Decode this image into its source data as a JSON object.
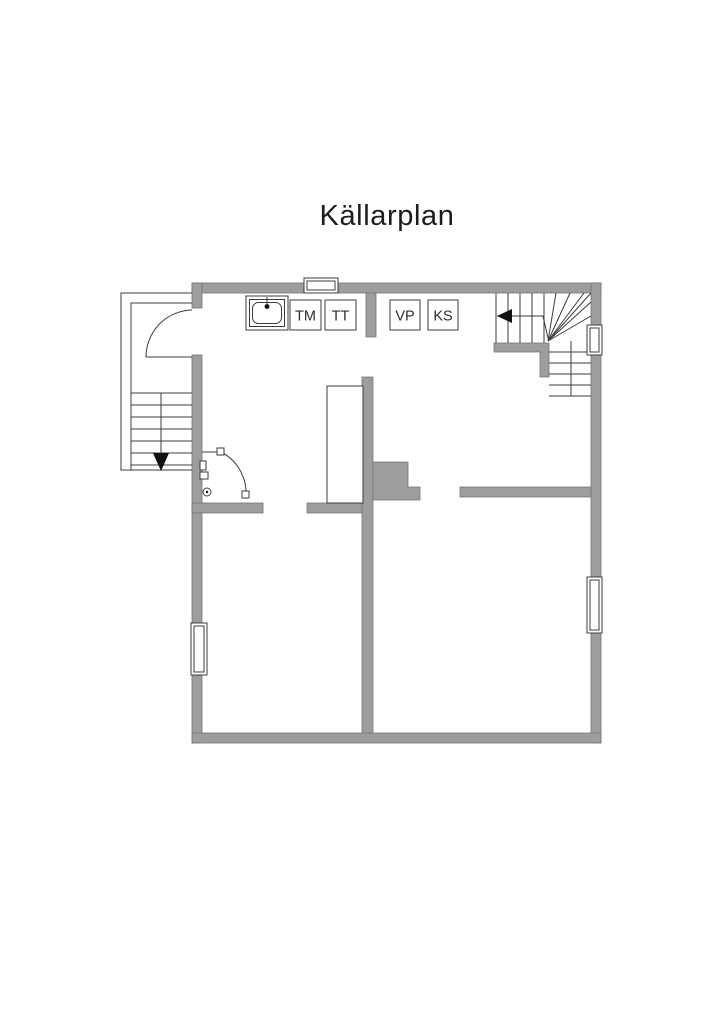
{
  "title": "Källarplan",
  "appliances": [
    {
      "label": "TM"
    },
    {
      "label": "TT"
    },
    {
      "label": "VP"
    },
    {
      "label": "KS"
    }
  ],
  "colors": {
    "wall-fill": "#9d9d9d",
    "wall-stroke": "#767676",
    "line-color": "#3c3c3c",
    "arrow-color": "#111111",
    "label-color": "#2d2d2d",
    "title-color": "#1c1c1c"
  }
}
